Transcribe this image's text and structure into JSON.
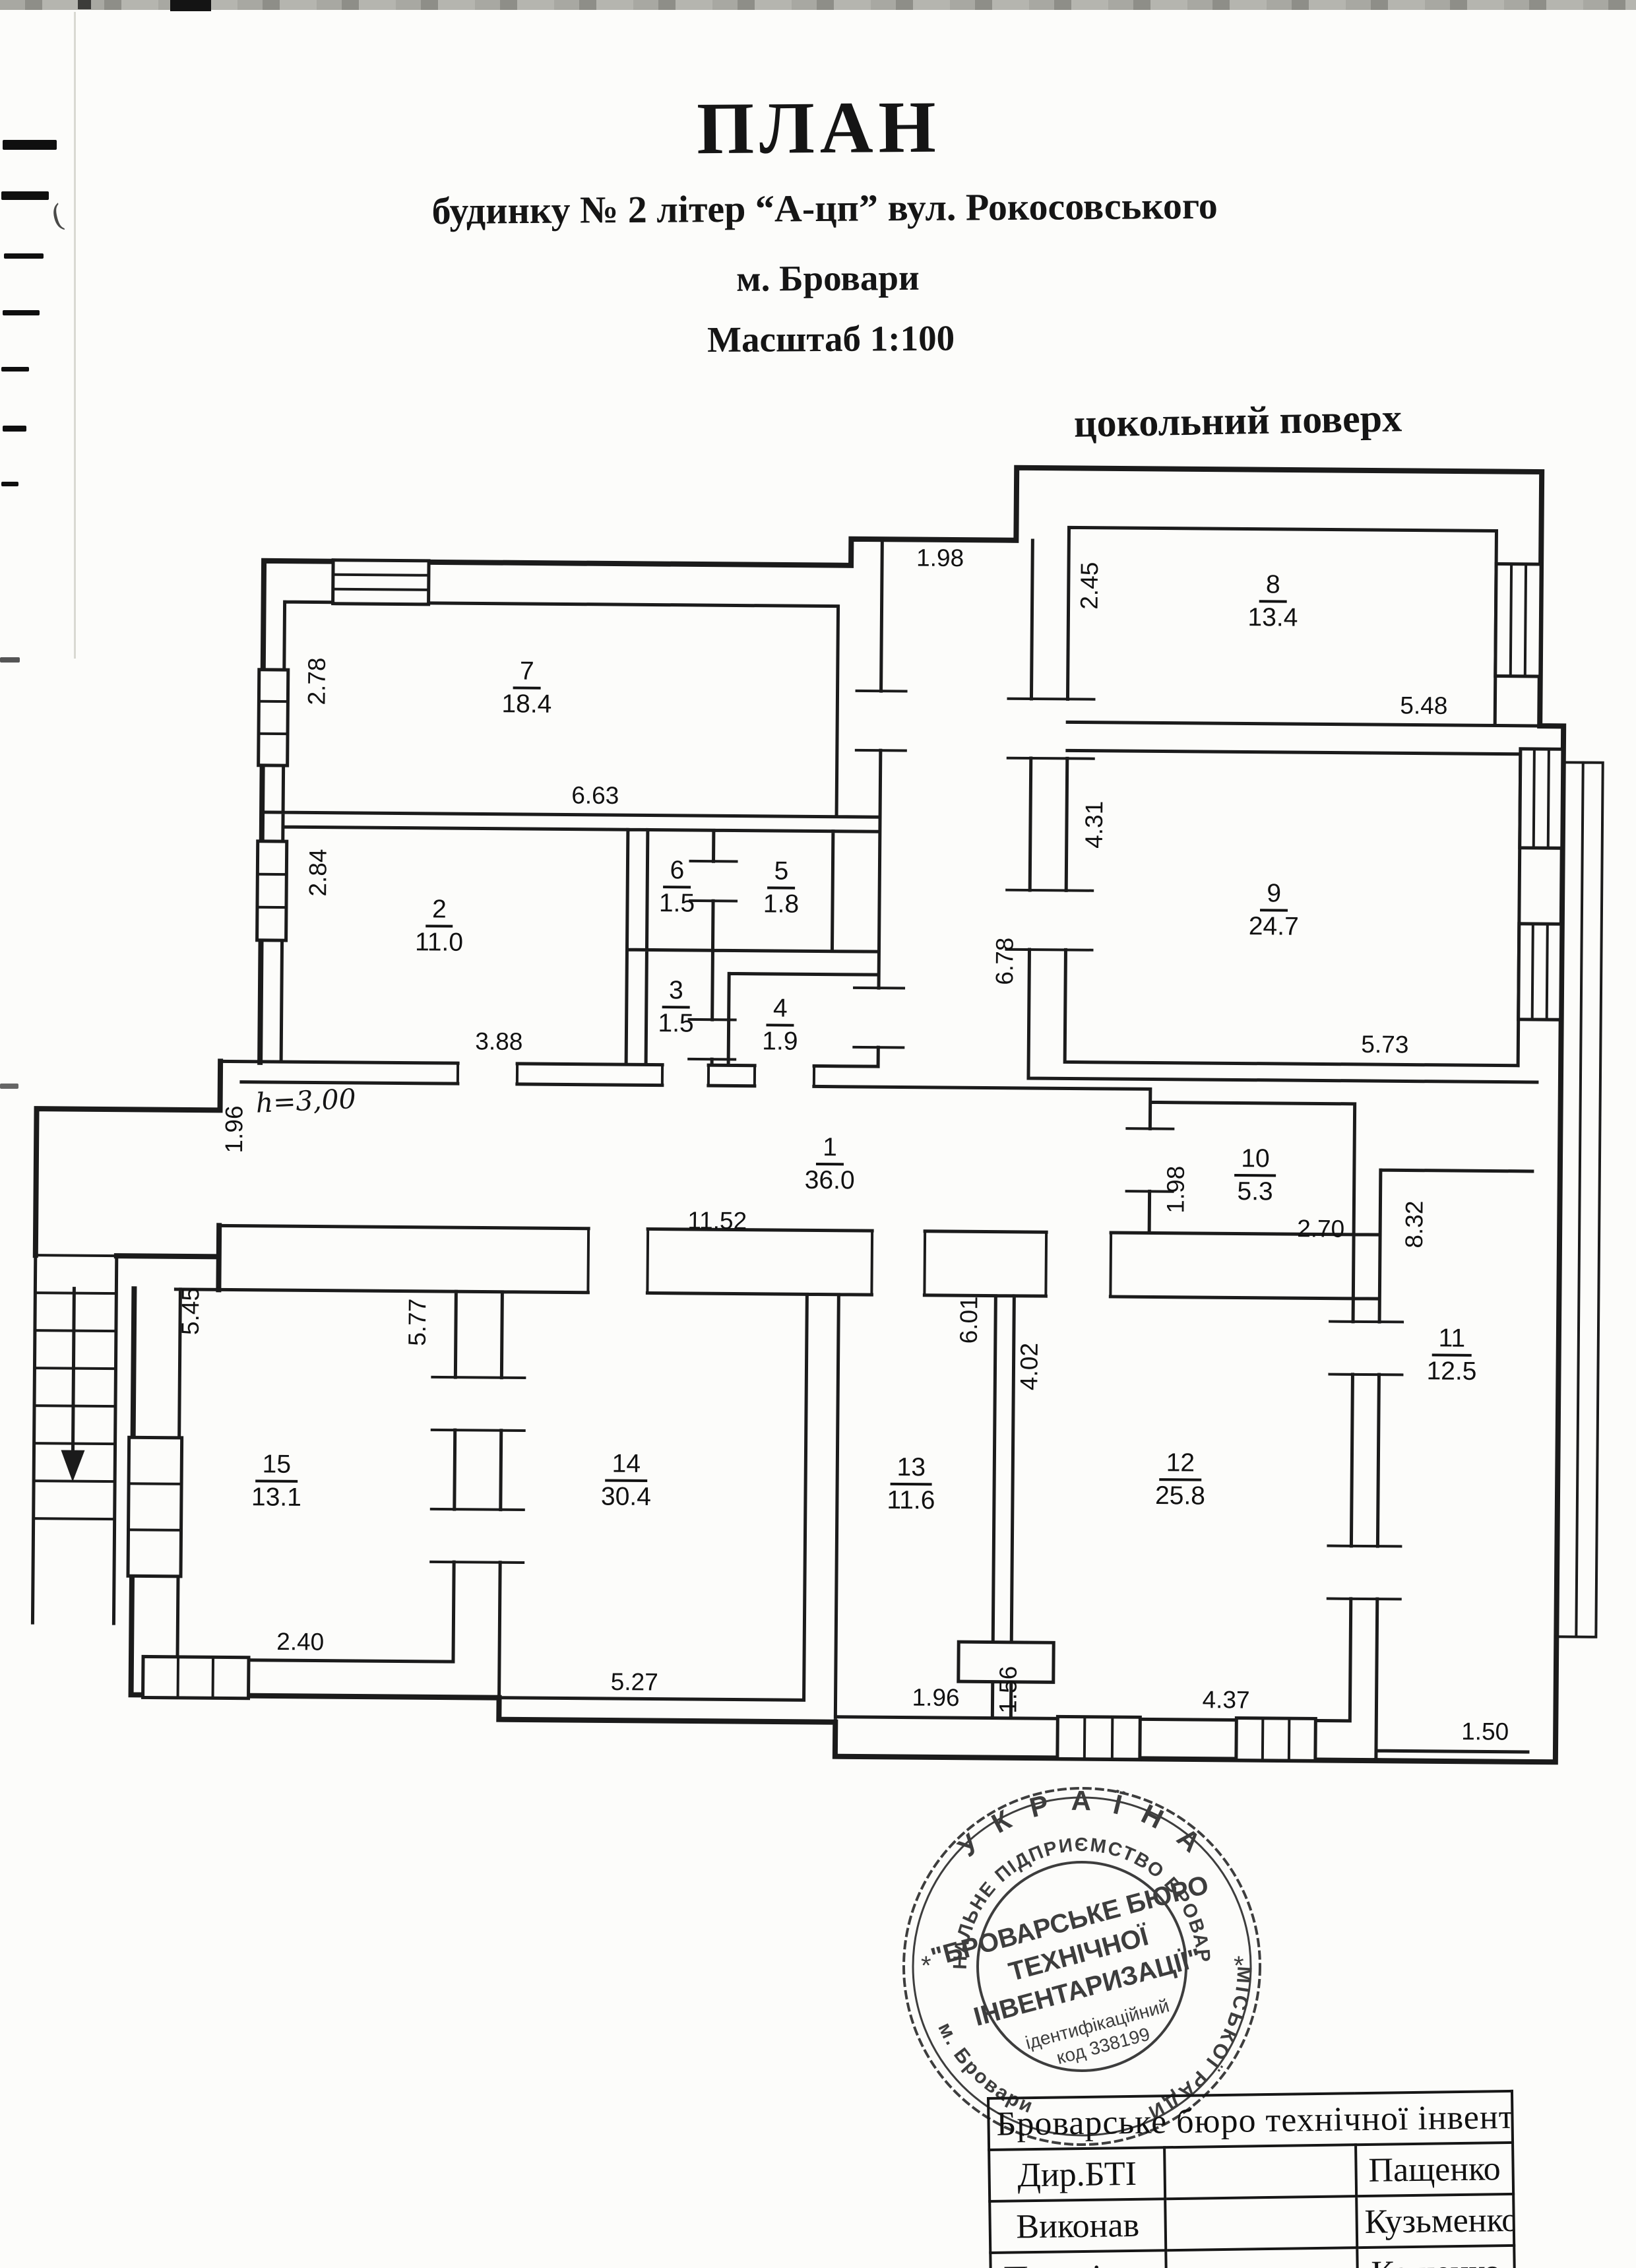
{
  "title": {
    "heading": "ПЛАН",
    "subtitle": "будинку № 2 літер “А-цп” вул. Рокосовського",
    "city": "м. Бровари",
    "scale": "Масштаб  1:100",
    "floor": "цокольний поверх"
  },
  "plan": {
    "height_note": "h=3,00",
    "rooms": [
      {
        "num": "1",
        "area": "36.0"
      },
      {
        "num": "2",
        "area": "11.0"
      },
      {
        "num": "3",
        "area": "1.5"
      },
      {
        "num": "4",
        "area": "1.9"
      },
      {
        "num": "5",
        "area": "1.8"
      },
      {
        "num": "6",
        "area": "1.5"
      },
      {
        "num": "7",
        "area": "18.4"
      },
      {
        "num": "8",
        "area": "13.4"
      },
      {
        "num": "9",
        "area": "24.7"
      },
      {
        "num": "10",
        "area": "5.3"
      },
      {
        "num": "11",
        "area": "12.5"
      },
      {
        "num": "12",
        "area": "25.8"
      },
      {
        "num": "13",
        "area": "11.6"
      },
      {
        "num": "14",
        "area": "30.4"
      },
      {
        "num": "15",
        "area": "13.1"
      }
    ],
    "dims": {
      "d198t": "1.98",
      "d245": "2.45",
      "d548": "5.48",
      "d431": "4.31",
      "d678": "6.78",
      "d573": "5.73",
      "d278": "2.78",
      "d663": "6.63",
      "d284": "2.84",
      "d388": "3.88",
      "d196l": "1.96",
      "d1152": "11.52",
      "d198r": "1.98",
      "d270": "2.70",
      "d832": "8.32",
      "d545": "5.45",
      "d577": "5.77",
      "d601": "6.01",
      "d402": "4.02",
      "d240": "2.40",
      "d527": "5.27",
      "d196b": "1.96",
      "d156": "1.56",
      "d437": "4.37",
      "d150": "1.50"
    }
  },
  "stamp": {
    "ring_top": "У К Р А Ї Н А",
    "ring_inner": "КОМУНАЛЬНЕ ПІДПРИЄМСТВО  БРОВАРСЬКОЇ",
    "ring_right": "МІСЬКОЇ  РАДИ",
    "ring_left": "м. Бровари",
    "star_left": "*",
    "star_right": "*",
    "center_line1": "\"БРОВАРСЬКЕ БЮРО",
    "center_line2": "ТЕХНІЧНОЇ",
    "center_line3": "ІНВЕНТАРИЗАЦІЇ\"",
    "code_line1": "ідентифікаційний",
    "code_line2": "код 338199"
  },
  "footer_table": {
    "header": "Броварське  бюро технічної інвентаризації",
    "rows": [
      {
        "role": "Дир.БТІ",
        "name": "Пащенко"
      },
      {
        "role": "Виконав",
        "name": "Кузьменко"
      },
      {
        "role": "Перевірив",
        "name": "Кащенко"
      }
    ]
  },
  "artifacts": {
    "stray_mark": "("
  }
}
